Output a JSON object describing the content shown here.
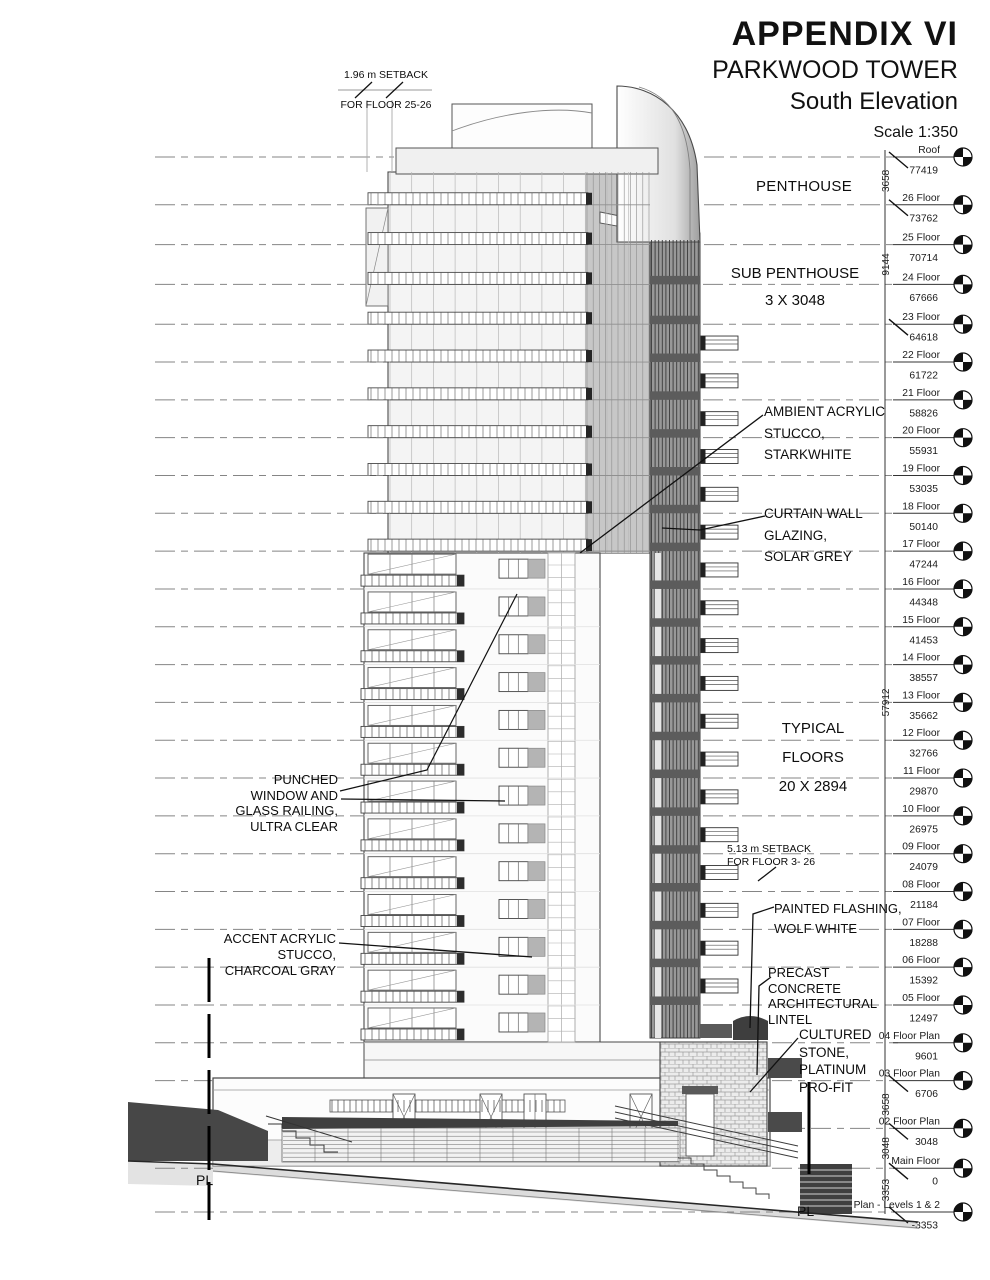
{
  "title_block": {
    "appendix": "APPENDIX VI",
    "project": "PARKWOOD TOWER",
    "view": "South Elevation",
    "scale": "Scale 1:350"
  },
  "annotations": {
    "setback_top": [
      "1.96 m SETBACK",
      "FOR FLOOR 25-26"
    ],
    "penthouse": "PENTHOUSE",
    "sub_penthouse": [
      "SUB PENTHOUSE",
      "3 X 3048"
    ],
    "ambient_stucco": [
      "AMBIENT ACRYLIC",
      "STUCCO,",
      "STARKWHITE"
    ],
    "curtain_wall": [
      "CURTAIN WALL",
      "GLAZING,",
      "SOLAR GREY"
    ],
    "typical_floors": [
      "TYPICAL FLOORS",
      "20 X 2894"
    ],
    "punched_window": [
      "PUNCHED",
      "WINDOW AND",
      "GLASS RAILING,",
      "ULTRA CLEAR"
    ],
    "setback_mid": [
      "5.13 m SETBACK",
      "FOR FLOOR 3- 26"
    ],
    "painted_flashing": [
      "PAINTED FLASHING,",
      "WOLF WHITE"
    ],
    "accent_stucco": [
      "ACCENT ACRYLIC",
      "STUCCO,",
      "CHARCOAL GRAY"
    ],
    "precast_lintel": [
      "PRECAST",
      "CONCRETE",
      "ARCHITECTURAL",
      "LINTEL"
    ],
    "cultured_stone": [
      "CULTURED",
      "STONE,",
      "PLATINUM",
      "PRO-FIT"
    ],
    "property_line_left": "PL",
    "property_line_right": "PL"
  },
  "levels": [
    {
      "name": "Roof",
      "elevation": "77419",
      "tick": true
    },
    {
      "name": "26 Floor",
      "elevation": "73762",
      "tick": true
    },
    {
      "name": "25 Floor",
      "elevation": "70714",
      "tick": false
    },
    {
      "name": "24 Floor",
      "elevation": "67666",
      "tick": false
    },
    {
      "name": "23 Floor",
      "elevation": "64618",
      "tick": true
    },
    {
      "name": "22 Floor",
      "elevation": "61722",
      "tick": false
    },
    {
      "name": "21 Floor",
      "elevation": "58826",
      "tick": false
    },
    {
      "name": "20 Floor",
      "elevation": "55931",
      "tick": false
    },
    {
      "name": "19 Floor",
      "elevation": "53035",
      "tick": false
    },
    {
      "name": "18 Floor",
      "elevation": "50140",
      "tick": false
    },
    {
      "name": "17 Floor",
      "elevation": "47244",
      "tick": false
    },
    {
      "name": "16 Floor",
      "elevation": "44348",
      "tick": false
    },
    {
      "name": "15 Floor",
      "elevation": "41453",
      "tick": false
    },
    {
      "name": "14 Floor",
      "elevation": "38557",
      "tick": false
    },
    {
      "name": "13 Floor",
      "elevation": "35662",
      "tick": false
    },
    {
      "name": "12 Floor",
      "elevation": "32766",
      "tick": false
    },
    {
      "name": "11 Floor",
      "elevation": "29870",
      "tick": false
    },
    {
      "name": "10 Floor",
      "elevation": "26975",
      "tick": false
    },
    {
      "name": "09 Floor",
      "elevation": "24079",
      "tick": false
    },
    {
      "name": "08 Floor",
      "elevation": "21184",
      "tick": false
    },
    {
      "name": "07 Floor",
      "elevation": "18288",
      "tick": false
    },
    {
      "name": "06 Floor",
      "elevation": "15392",
      "tick": false
    },
    {
      "name": "05 Floor",
      "elevation": "12497",
      "tick": false
    },
    {
      "name": "04 Floor Plan",
      "elevation": "9601",
      "tick": false
    },
    {
      "name": "03 Floor Plan",
      "elevation": "6706",
      "tick": true
    },
    {
      "name": "02 Floor Plan",
      "elevation": "3048",
      "tick": true
    },
    {
      "name": "Main Floor",
      "elevation": "0",
      "tick": true
    },
    {
      "name": "Parkade Plan - Levels 1 & 2",
      "elevation": "-3353",
      "tick": true
    }
  ],
  "dimensions": [
    {
      "label": "3658",
      "top": 77419,
      "bottom": 73762
    },
    {
      "label": "9144",
      "top": 73762,
      "bottom": 64618
    },
    {
      "label": "57912",
      "top": 64618,
      "bottom": 6706
    },
    {
      "label": "3658",
      "top": 6706,
      "bottom": 3048
    },
    {
      "label": "3048",
      "top": 3048,
      "bottom": 0
    },
    {
      "label": "3353",
      "top": 0,
      "bottom": -3353
    }
  ],
  "icons": {
    "level_marker": "level-target-icon"
  },
  "colors": {
    "line": "#3c3c3c",
    "dashed": "#858585",
    "dark_mass": "#474747",
    "curtain_dark": "#989898",
    "facade_light": "#f4f4f4",
    "glass_mid": "#c7c7c7",
    "spandrel": "#5c5c5c",
    "text": "#0d0d0d"
  }
}
